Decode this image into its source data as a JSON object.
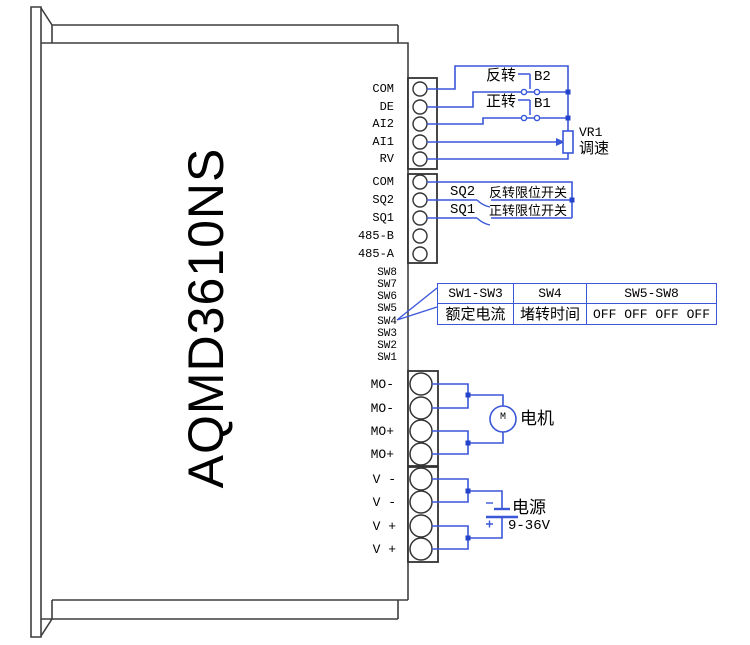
{
  "device": {
    "model": "AQMD3610NS"
  },
  "terminal_blocks": {
    "signal1": {
      "terminals": [
        "COM",
        "DE",
        "AI2",
        "AI1",
        "RV"
      ]
    },
    "signal2": {
      "terminals": [
        "COM",
        "SQ2",
        "SQ1",
        "485-B",
        "485-A"
      ]
    },
    "dip": {
      "labels": [
        "SW8",
        "SW7",
        "SW6",
        "SW5",
        "SW4",
        "SW3",
        "SW2",
        "SW1"
      ]
    },
    "motor": {
      "terminals": [
        "MO-",
        "MO-",
        "MO+",
        "MO+"
      ]
    },
    "power": {
      "terminals": [
        "V -",
        "V -",
        "V +",
        "V +"
      ]
    }
  },
  "annotations": {
    "reverse_button_label": "反转",
    "reverse_button_id": "B2",
    "forward_button_label": "正转",
    "forward_button_id": "B1",
    "pot_id": "VR1",
    "pot_label": "调速",
    "reverse_limit_id": "SQ2",
    "reverse_limit_label": "反转限位开关",
    "forward_limit_id": "SQ1",
    "forward_limit_label": "正转限位开关",
    "motor_symbol": "M",
    "motor_label": "电机",
    "power_label": "电源",
    "power_voltage": "9-36V"
  },
  "dip_table": {
    "headers": [
      "SW1-SW3",
      "SW4",
      "SW5-SW8"
    ],
    "values": [
      "额定电流",
      "堵转时间",
      "OFF OFF OFF OFF"
    ]
  },
  "colors": {
    "wire_blue": "#3a57d8",
    "junction_blue": "#2443cb",
    "outline_gray": "#3f3f3f"
  }
}
